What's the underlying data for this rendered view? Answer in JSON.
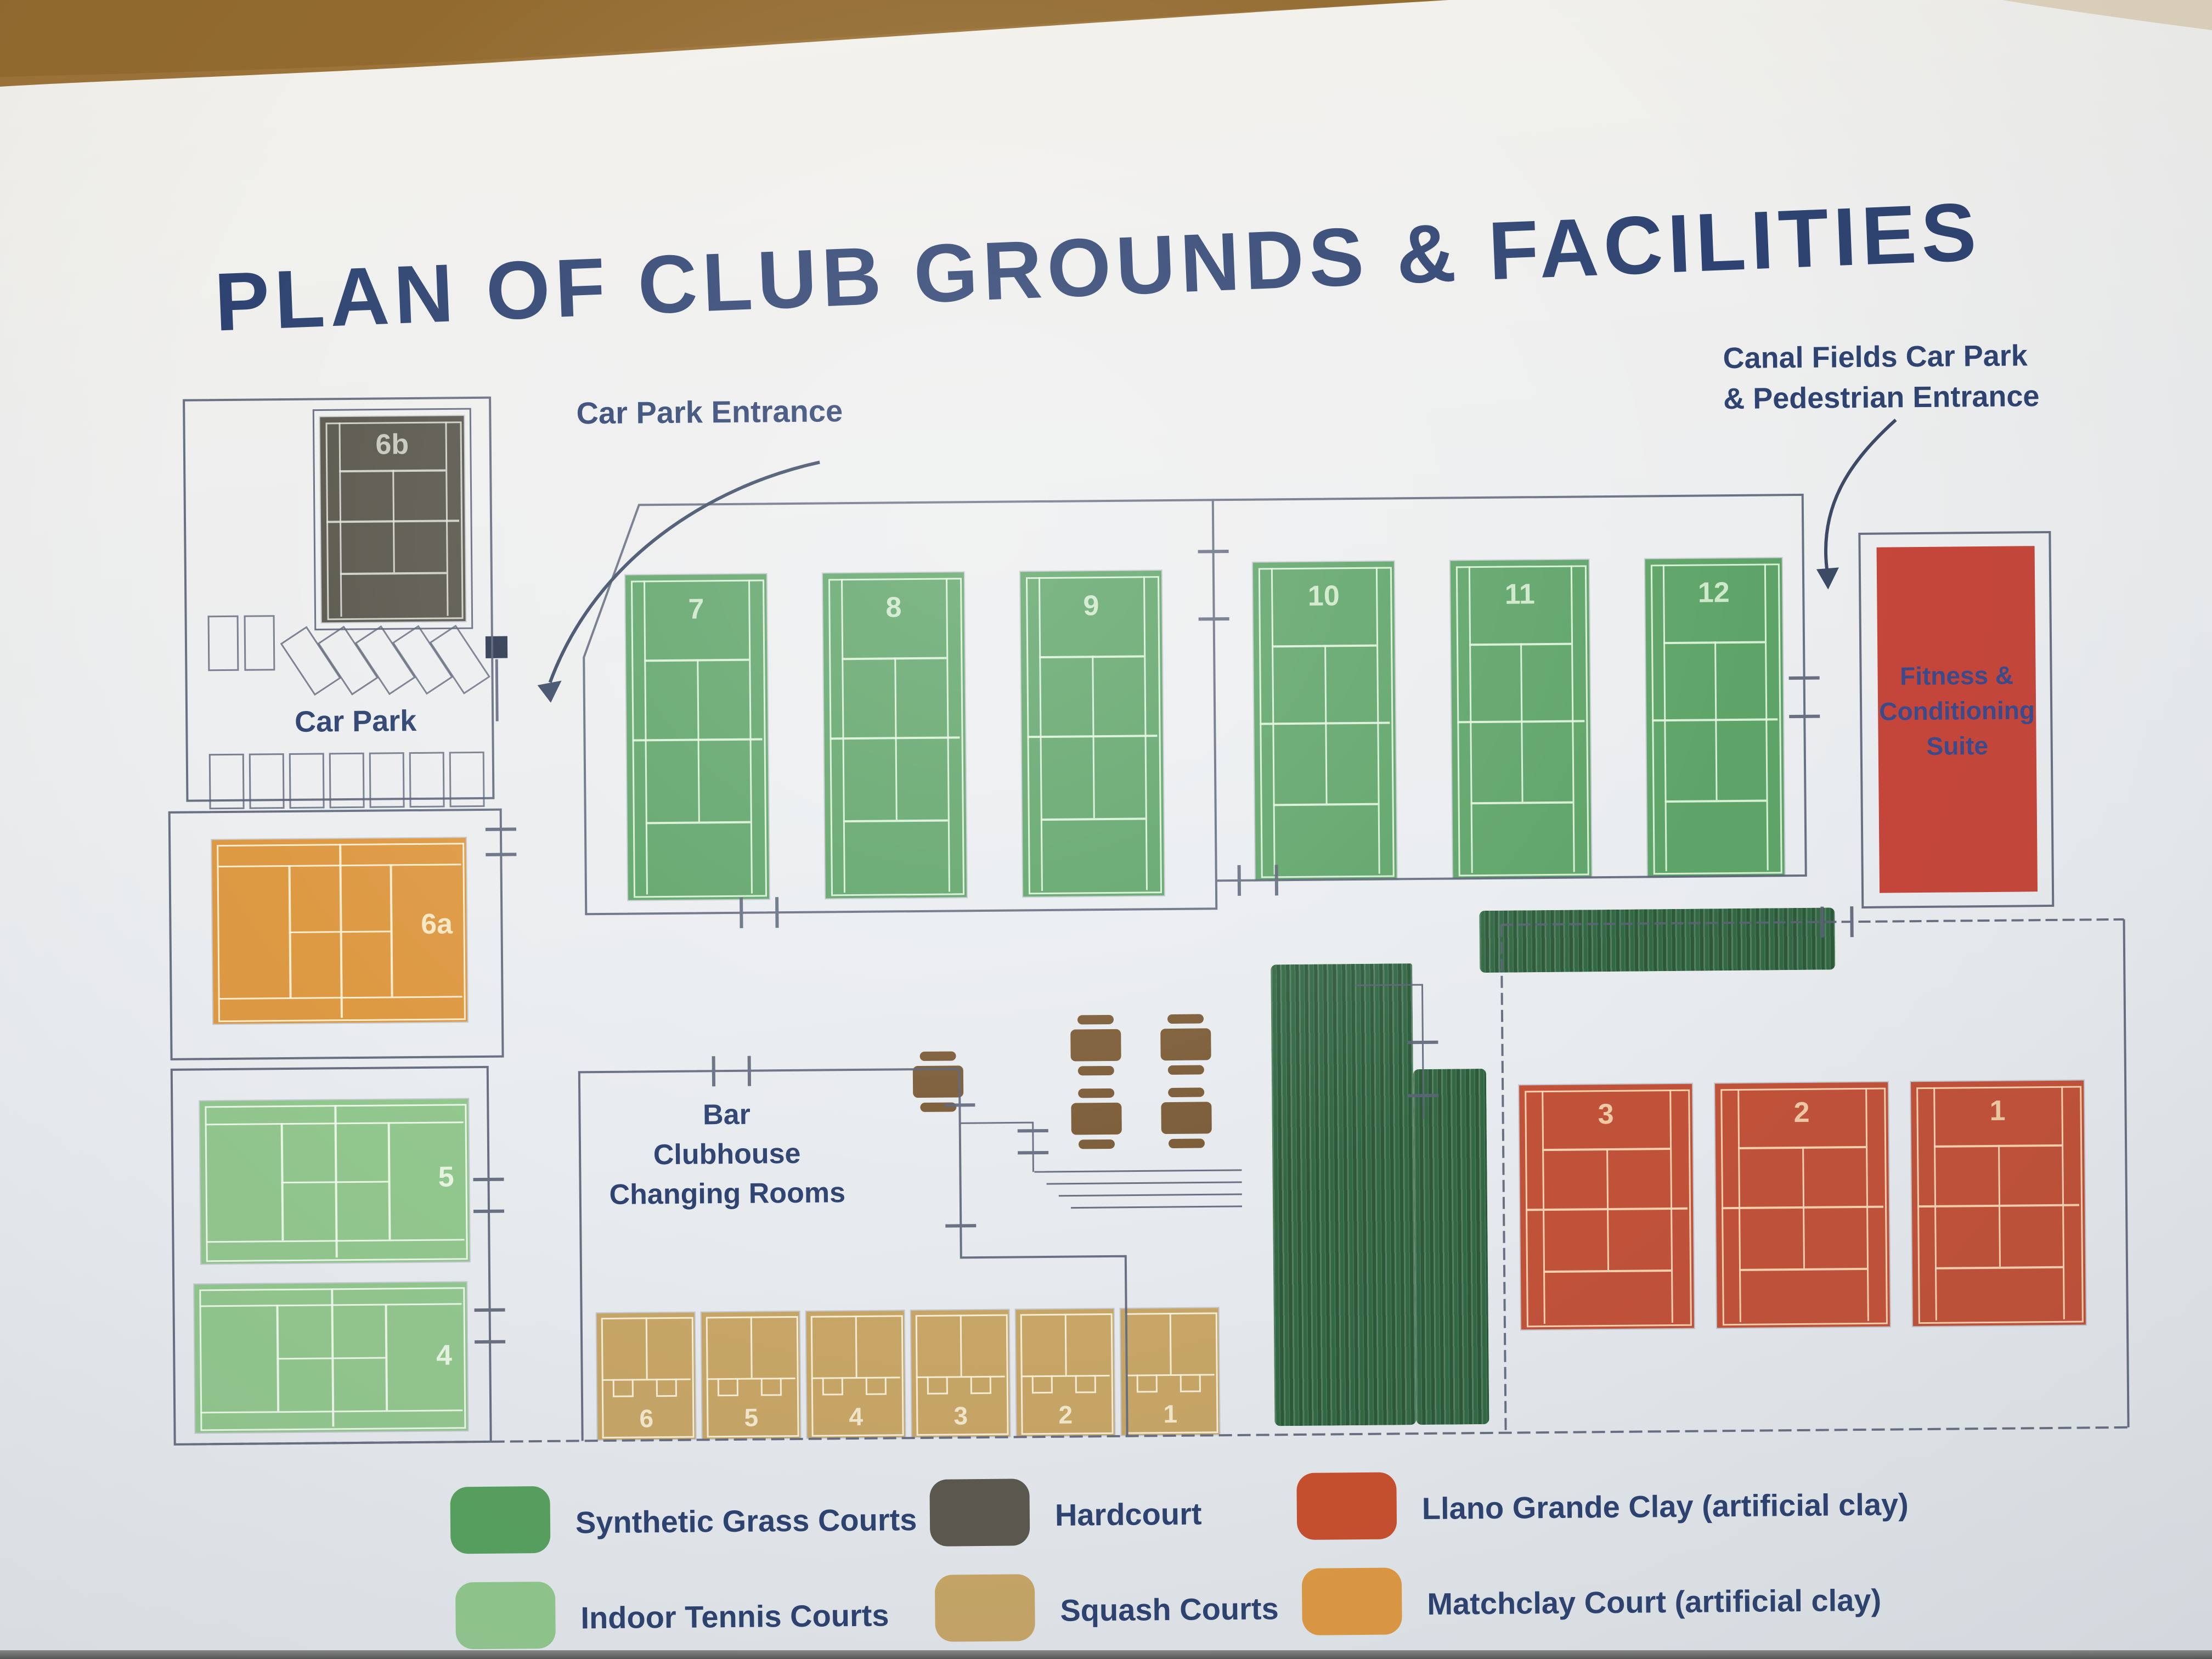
{
  "title": "PLAN OF CLUB GROUNDS & FACILITIES",
  "labels": {
    "car_park_entrance": "Car Park Entrance",
    "canal_fields": [
      "Canal Fields Car Park",
      "& Pedestrian Entrance"
    ],
    "car_park": "Car Park",
    "clubhouse": [
      "Bar",
      "Clubhouse",
      "Changing Rooms"
    ],
    "fitness": [
      "Fitness &",
      "Conditioning",
      "Suite"
    ]
  },
  "courts": {
    "hardcourt": [
      "6b"
    ],
    "synthetic": [
      "7",
      "8",
      "9",
      "10",
      "11",
      "12"
    ],
    "matchclay": [
      "6a"
    ],
    "indoor": [
      "5",
      "4"
    ],
    "clay": [
      "3",
      "2",
      "1"
    ],
    "squash": [
      "6",
      "5",
      "4",
      "3",
      "2",
      "1"
    ]
  },
  "legend": [
    {
      "key": "synthetic",
      "color": "#58a15f",
      "label": "Synthetic Grass Courts"
    },
    {
      "key": "hardcourt",
      "color": "#5b584e",
      "label": "Hardcourt"
    },
    {
      "key": "clay",
      "color": "#c8502f",
      "label": "Llano Grande Clay (artificial clay)"
    },
    {
      "key": "indoor",
      "color": "#92c78e",
      "label": "Indoor Tennis Courts"
    },
    {
      "key": "squash",
      "color": "#c7a667",
      "label": "Squash Courts"
    },
    {
      "key": "matchclay",
      "color": "#de9943",
      "label": "Matchclay Court (artificial clay)"
    }
  ],
  "colors": {
    "title_blue": "#2e4371",
    "plan_line": "#5b6377",
    "synthetic_green": "#5ea468",
    "indoor_green": "#92c78e",
    "hardcourt_grey": "#5b584e",
    "clay_red": "#c2523a",
    "matchclay_orange": "#de9943",
    "squash_tan": "#c7a667",
    "fitness_red": "#c6463a",
    "hedge_green": "#336844",
    "table_brown": "#7b5b36"
  }
}
